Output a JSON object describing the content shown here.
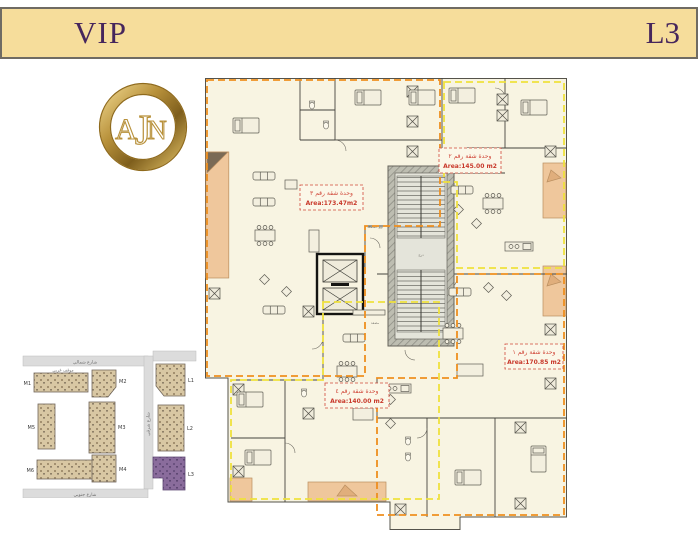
{
  "slide": {
    "title_left": "VIP",
    "floor_label": "L3"
  },
  "logo": {
    "letters": [
      "A",
      "J",
      "N"
    ]
  },
  "floor_plan": {
    "units": [
      {
        "name": "وحدة شقة رقم ٣",
        "area": "Area:173.47m2"
      },
      {
        "name": "وحدة شقة رقم ٢",
        "area": "Area:145.00 m2"
      },
      {
        "name": "وحدة شقة رقم ١",
        "area": "Area:170.85 m2"
      },
      {
        "name": "وحدة شقة رقم ٤",
        "area": "Area:140.00 m2"
      }
    ],
    "core": {
      "lobby_label": "بهو المصعد",
      "stair_label": "درج",
      "elevator_label": "مصعد"
    }
  },
  "key_plan": {
    "streets": {
      "north": "شارع شمالي",
      "east": "شارع شرقي",
      "south": "شارع جنوبي"
    },
    "group_captions": {
      "left": "موقف غربي",
      "right": "موقف شرقي"
    },
    "blocks_left": [
      "M1",
      "M2",
      "M5",
      "M3",
      "M6",
      "M4"
    ],
    "blocks_right": [
      "L1",
      "L2",
      "L3"
    ],
    "highlighted_block": "L3"
  },
  "colors": {
    "header_bg": "#F6DD9B",
    "header_text": "#46265C",
    "accent_orange": "#EE8F1F",
    "accent_yellow": "#EFE13D",
    "label_red": "#C8392B",
    "balcony": "#EFC79C",
    "highlight_purple": "#8A6C9C"
  }
}
